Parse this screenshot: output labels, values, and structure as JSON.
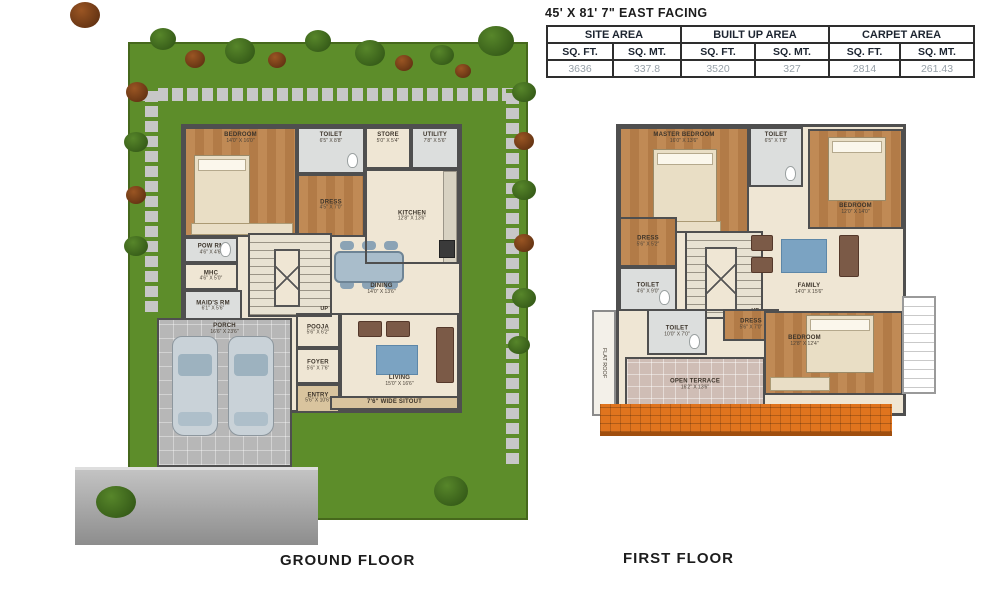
{
  "title_block": {
    "title": "45' X 81' 7\" EAST FACING",
    "table": {
      "groups": [
        "SITE AREA",
        "BUILT UP AREA",
        "CARPET AREA"
      ],
      "subheaders": [
        "SQ. FT.",
        "SQ. MT.",
        "SQ. FT.",
        "SQ. MT.",
        "SQ. FT.",
        "SQ. MT."
      ],
      "values": [
        "3636",
        "337.8",
        "3520",
        "327",
        "2814",
        "261.43"
      ]
    }
  },
  "ground_floor": {
    "label": "GROUND FLOOR",
    "stairs_up": "UP",
    "rooms": {
      "bedroom": {
        "name": "BEDROOM",
        "dims": "14'0\" X 16'0\""
      },
      "toilet": {
        "name": "TOILET",
        "dims": "6'5\" X 8'8\""
      },
      "dress": {
        "name": "DRESS",
        "dims": "4'5\" X 7'0\""
      },
      "store": {
        "name": "STORE",
        "dims": "5'0\" X 5'4\""
      },
      "utility": {
        "name": "UTILITY",
        "dims": "7'8\" X 5'6\""
      },
      "kitchen": {
        "name": "KITCHEN",
        "dims": "12'8\" X 13'6\""
      },
      "pow_rm": {
        "name": "POW RM",
        "dims": "4'6\" X 4'6\""
      },
      "mhc": {
        "name": "MHC",
        "dims": "4'6\" X 5'0\""
      },
      "maids_rm": {
        "name": "MAID'S RM",
        "dims": "6'1\" X 5'6\""
      },
      "dining": {
        "name": "DINING",
        "dims": "14'0\" X 13'6\""
      },
      "pooja": {
        "name": "POOJA",
        "dims": "5'6\" X 6'2\""
      },
      "foyer": {
        "name": "FOYER",
        "dims": "5'6\" X 7'6\""
      },
      "entry": {
        "name": "ENTRY",
        "dims": "5'6\" X 10'6\""
      },
      "porch": {
        "name": "PORCH",
        "dims": "16'6\" X 23'6\""
      },
      "living": {
        "name": "LIVING",
        "dims": "15'0\" X 16'6\""
      },
      "sitout": {
        "name": "7'6\" WIDE SITOUT"
      }
    }
  },
  "first_floor": {
    "label": "FIRST FLOOR",
    "stairs_up": "UP",
    "stairs_dn": "DN",
    "rooms": {
      "master": {
        "name": "MASTER BEDROOM",
        "dims": "16'0\" X 13'6\""
      },
      "toilet_a": {
        "name": "TOILET",
        "dims": "6'5\" X 7'8\""
      },
      "bedroom_a": {
        "name": "BEDROOM",
        "dims": "12'0\" X 14'0\""
      },
      "dress_a": {
        "name": "DRESS",
        "dims": "5'6\" X 5'2\""
      },
      "toilet_b": {
        "name": "TOILET",
        "dims": "4'6\" X 9'0\""
      },
      "family": {
        "name": "FAMILY",
        "dims": "14'0\" X 15'6\""
      },
      "toilet_c": {
        "name": "TOILET",
        "dims": "10'0\" X 7'0\""
      },
      "dress_b": {
        "name": "DRESS",
        "dims": "5'6\" X 7'0\""
      },
      "bedroom_b": {
        "name": "BEDROOM",
        "dims": "12'8\" X 12'4\""
      },
      "terrace": {
        "name": "OPEN TERRACE",
        "dims": "16'2\" X 13'6\""
      },
      "flat_roof": {
        "name": "FLAT ROOF"
      }
    }
  },
  "colors": {
    "grass": "#5d8d2a",
    "wall": "#4f4f4f",
    "wood_floor": "#c08a55",
    "plan_floor": "#efe6d4",
    "roof_tile": "#e0741e",
    "table_value_text": "#96a0a8"
  }
}
